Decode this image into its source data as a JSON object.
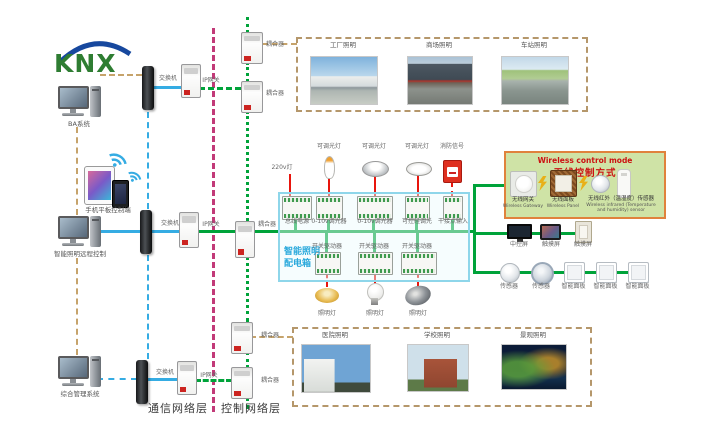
{
  "logo": {
    "text": "KNX"
  },
  "left_column": {
    "pc1_label": "BA系统",
    "pc2_label": "智能照明远程控制",
    "pc3_label": "综合管理系统",
    "mobile_label": "手机平板控制端"
  },
  "network": {
    "switch_label": "交换机",
    "gateway_label": "IP网关",
    "coupler_label": "耦合器"
  },
  "layer_labels": {
    "communication": "通信网络层",
    "control": "控制网络层"
  },
  "top_scenes": {
    "labels": [
      "工厂照明",
      "商场照明",
      "车站照明"
    ]
  },
  "bottom_scenes": {
    "labels": [
      "医院照明",
      "学校照明",
      "景观照明"
    ]
  },
  "distribution_box": {
    "title_line1": "智能照明",
    "title_line2": "配电箱",
    "top_modules": [
      "总线电源",
      "0-10v调光器",
      "0-10v调光器",
      "可控硅调光",
      "干接点输入"
    ],
    "bottom_modules": [
      "开关驱动器",
      "开关驱动器",
      "开关驱动器"
    ],
    "lamp_220v": "220v灯",
    "dimmable_lamp": "可调光灯",
    "fire_signal": "消防信号",
    "lighting_lamp": "照明灯"
  },
  "wireless_box": {
    "title_en": "Wireless control mode",
    "title_cn": "无线控制方式",
    "devices": [
      {
        "cn": "无线网关",
        "en": "Wireless Gateway"
      },
      {
        "cn": "无线面板",
        "en": "Wireless Panel"
      },
      {
        "cn": "无线红外（温湿度）传感器",
        "en": "Wireless infrared (Temperature and humidity) sensor"
      }
    ]
  },
  "right_devices": {
    "screens": [
      "中控屏",
      "触摸屏",
      "触摸屏"
    ],
    "sensors": [
      "传感器",
      "传感器",
      "智能面板",
      "智能面板",
      "智能面板"
    ]
  },
  "colors": {
    "bus_green": "#00a33a",
    "ethernet_blue": "#35ace3",
    "backbone_khaki": "#c6a36b",
    "layer_divider_magenta": "#c23a78",
    "load_red": "#e8150d",
    "wireless_bg": "#cfe3a6",
    "wireless_border": "#e0823c",
    "distribution_border": "#8ed6ea"
  }
}
